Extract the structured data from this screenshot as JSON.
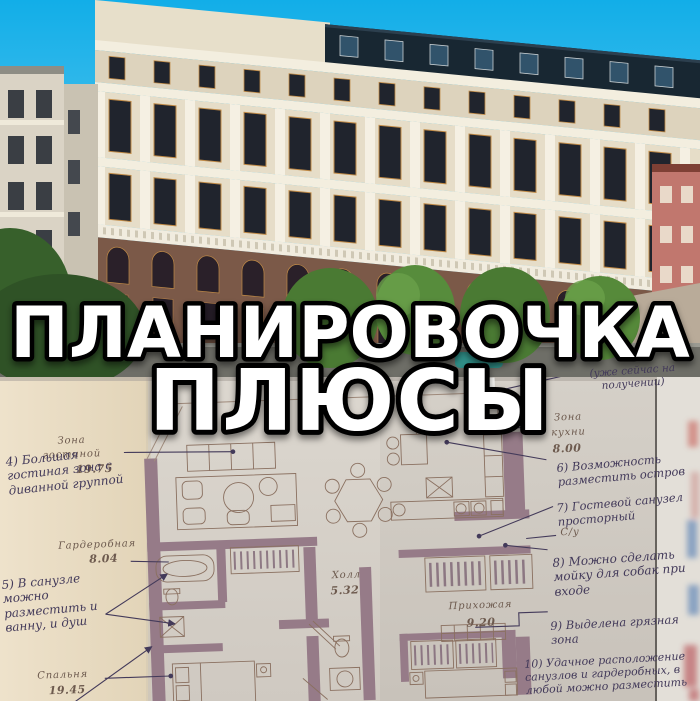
{
  "title": {
    "line1": "ПЛАНИРОВОЧКА",
    "line2": "ПЛЮСЫ"
  },
  "photo": {
    "subject": "classical-residential-building-facade"
  },
  "plan": {
    "rooms": [
      {
        "id": "living",
        "line1": "Зона",
        "line2": "гостиной",
        "area": "19.75"
      },
      {
        "id": "wardrobe",
        "line1": "Гардеробная",
        "line2": "",
        "area": "8.04"
      },
      {
        "id": "bedroom",
        "line1": "Спальня",
        "line2": "",
        "area": "19.45"
      },
      {
        "id": "hall",
        "line1": "Холл",
        "line2": "",
        "area": "5.32"
      },
      {
        "id": "entry",
        "line1": "Прихожая",
        "line2": "",
        "area": "9.20"
      },
      {
        "id": "kitchen",
        "line1": "Зона",
        "line2": "кухни",
        "area": "8.00"
      },
      {
        "id": "wc",
        "line1": "С/у",
        "line2": "",
        "area": ""
      }
    ],
    "annotations": [
      {
        "id": "note-3-partial",
        "text": "(уже сейчас на получении)"
      },
      {
        "id": "note-4",
        "text": "4) Большая гостиная зона с диванной группой"
      },
      {
        "id": "note-5",
        "text": "5) В санузле можно разместить и ванну, и душ"
      },
      {
        "id": "note-6",
        "text": "6) Возможность разместить остров"
      },
      {
        "id": "note-7",
        "text": "7) Гостевой санузел просторный"
      },
      {
        "id": "note-8",
        "text": "8) Можно сделать мойку для собак при входе"
      },
      {
        "id": "note-9",
        "text": "9) Выделена грязная зона"
      },
      {
        "id": "note-10",
        "text": "10) Удачное расположение санузлов и гардеробных, в любой можно разместить"
      }
    ]
  },
  "colors": {
    "sky_top": "#12aee8",
    "sky_bottom": "#8fd8f3",
    "facade": "#e6ddc8",
    "facade_white": "#f3eedf",
    "roof": "#182732",
    "window": "#20242d",
    "window_frame": "#c08a46",
    "brick": "#7b5948",
    "foliage": "#47792f",
    "street": "#6e6e67",
    "paper": "#d6d1c9",
    "margin_paper": "#e9ddc5",
    "plan_wall": "#967b88",
    "plan_line": "#8a7060",
    "ink": "#433a5a",
    "label": "#6d5a4e",
    "title_fill": "#ffffff",
    "title_stroke": "#000000"
  }
}
